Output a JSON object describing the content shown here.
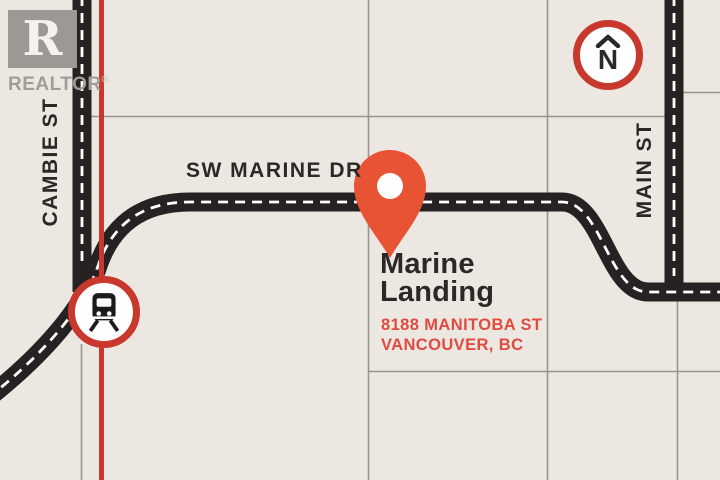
{
  "branding": {
    "logo_letter": "R",
    "logo_text": "REALTOR",
    "registered_mark": "®"
  },
  "compass": {
    "north_label": "N"
  },
  "streets": {
    "cambie": "CAMBIE ST",
    "sw_marine": "SW MARINE DR",
    "main": "MAIN ST"
  },
  "property": {
    "name_line1": "Marine",
    "name_line2": "Landing",
    "address_street": "8188 MANITOBA ST",
    "address_city": "VANCOUVER, BC"
  },
  "colors": {
    "background": "#ece8e1",
    "road_black": "#262122",
    "road_dash_white": "#ffffff",
    "block_grid_gray": "#98948e",
    "transit_line_red": "#c8382d",
    "pin_orange": "#e85334",
    "address_red": "#e04b40",
    "text_dark": "#2b2827",
    "logo_gray": "#9c9894"
  }
}
